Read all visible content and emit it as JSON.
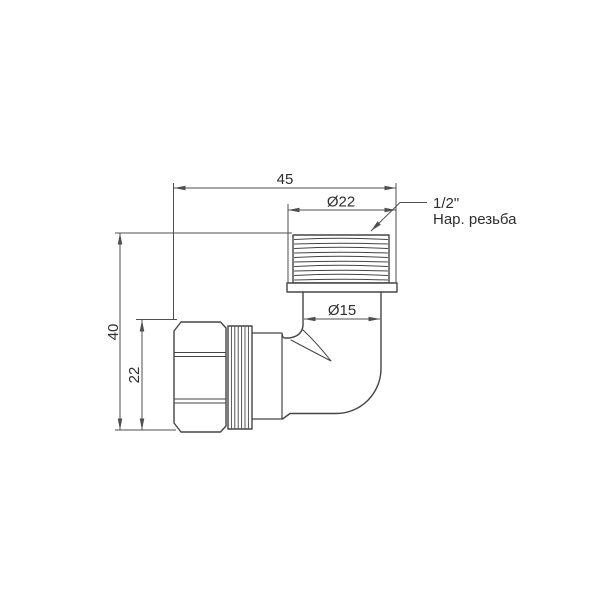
{
  "drawing": {
    "kind": "technical-line-drawing",
    "colors": {
      "background": "#ffffff",
      "outline": "#454545",
      "dimension": "#4f4f4f",
      "text": "#2e2e2e"
    },
    "dimensions": {
      "overall_width": "45",
      "thread_diameter": "Ø22",
      "bore_diameter": "Ø15",
      "overall_height": "40",
      "nut_height": "22"
    },
    "callout": {
      "line1": "1/2\"",
      "line2": "Нар. резьба"
    }
  }
}
